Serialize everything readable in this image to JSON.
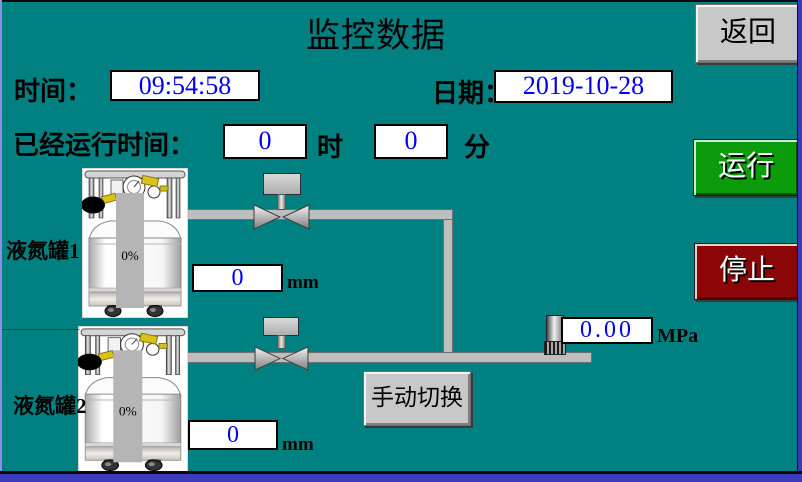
{
  "title": "监控数据",
  "colors": {
    "background": "#008080",
    "value_text_blue": "#0000ee",
    "run_green": "#0b9b0b",
    "stop_red": "#8b0606",
    "button_gray": "#c8c8c8"
  },
  "header": {
    "back_button_label": "返回",
    "time_label": "时间：",
    "time_value": "09:54:58",
    "date_label": "日期：",
    "date_value": "2019-10-28"
  },
  "runtime": {
    "label": "已经运行时间：",
    "hours_value": "0",
    "hours_unit": "时",
    "minutes_value": "0",
    "minutes_unit": "分"
  },
  "tanks": [
    {
      "label": "液氮罐1",
      "level_percent": "0%",
      "level_value": "0",
      "level_unit": "mm"
    },
    {
      "label": "液氮罐2",
      "level_percent": "0%",
      "level_value": "0",
      "level_unit": "mm"
    }
  ],
  "pressure": {
    "value": "0.00",
    "unit": "MPa"
  },
  "controls": {
    "run_button_label": "运行",
    "stop_button_label": "停止",
    "manual_switch_label": "手动切换"
  }
}
